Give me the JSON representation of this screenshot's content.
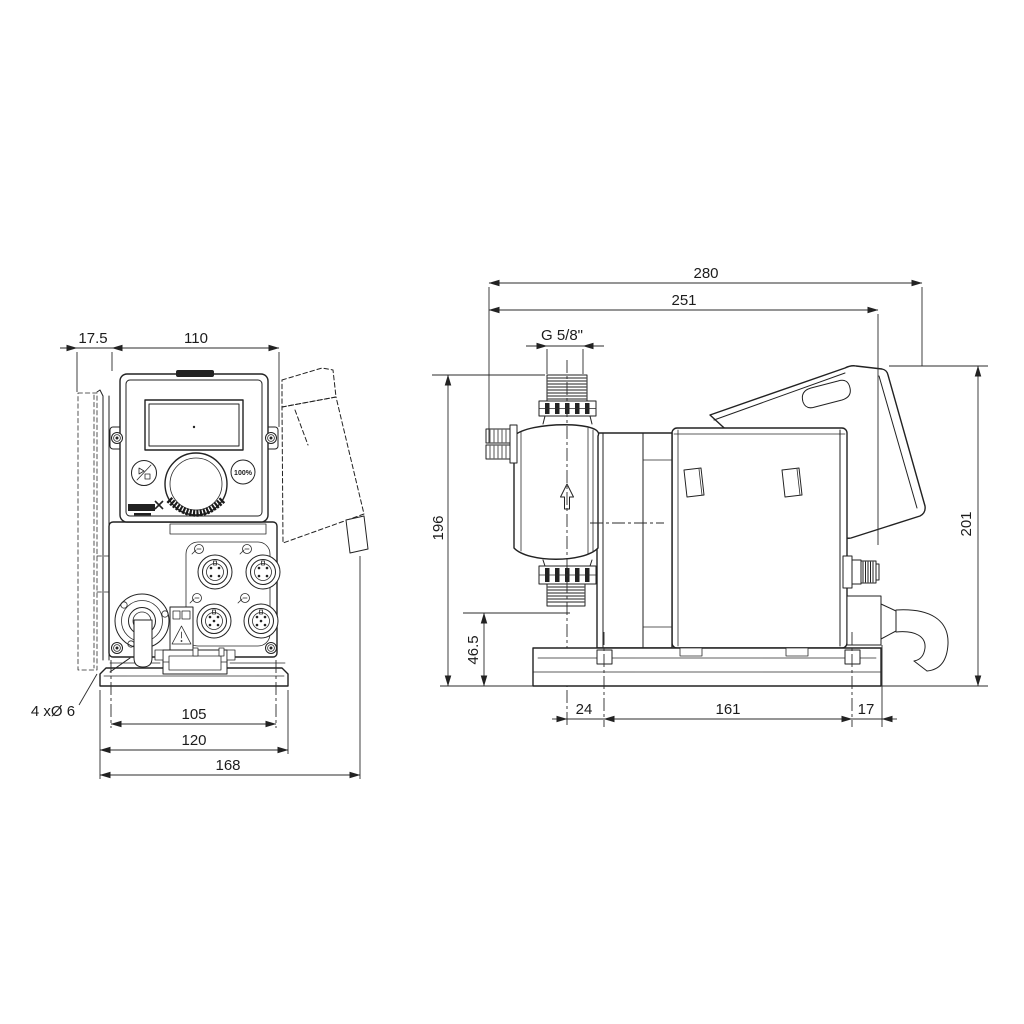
{
  "page": {
    "background": "#ffffff",
    "line_color": "#222222"
  },
  "drawing_type": "dosing pump dimensional drawing, front and side views",
  "front_view": {
    "label": "front-view",
    "dims": {
      "bracket_offset": "17.5",
      "body_width": "110",
      "foot_hole_spacing": "105",
      "foot_width": "120",
      "overall_width": "168"
    },
    "mounting_holes_note": "4 xØ 6",
    "control_panel": {
      "boost_button_label": "100%"
    }
  },
  "side_view": {
    "label": "side-view",
    "dims": {
      "overall_length": "280",
      "length_to_cover": "251",
      "connection_thread": "G 5/8\"",
      "height_to_connection": "196",
      "suction_height": "46.5",
      "overall_height": "201",
      "foot_offset_front": "24",
      "foot_hole_spacing": "161",
      "foot_offset_rear": "17"
    }
  },
  "icons": {
    "brand": "grundfos-logo",
    "start_stop": "start-stop-icon",
    "warning": "warning-triangle-icon",
    "flow": "flow-direction-arrow"
  }
}
